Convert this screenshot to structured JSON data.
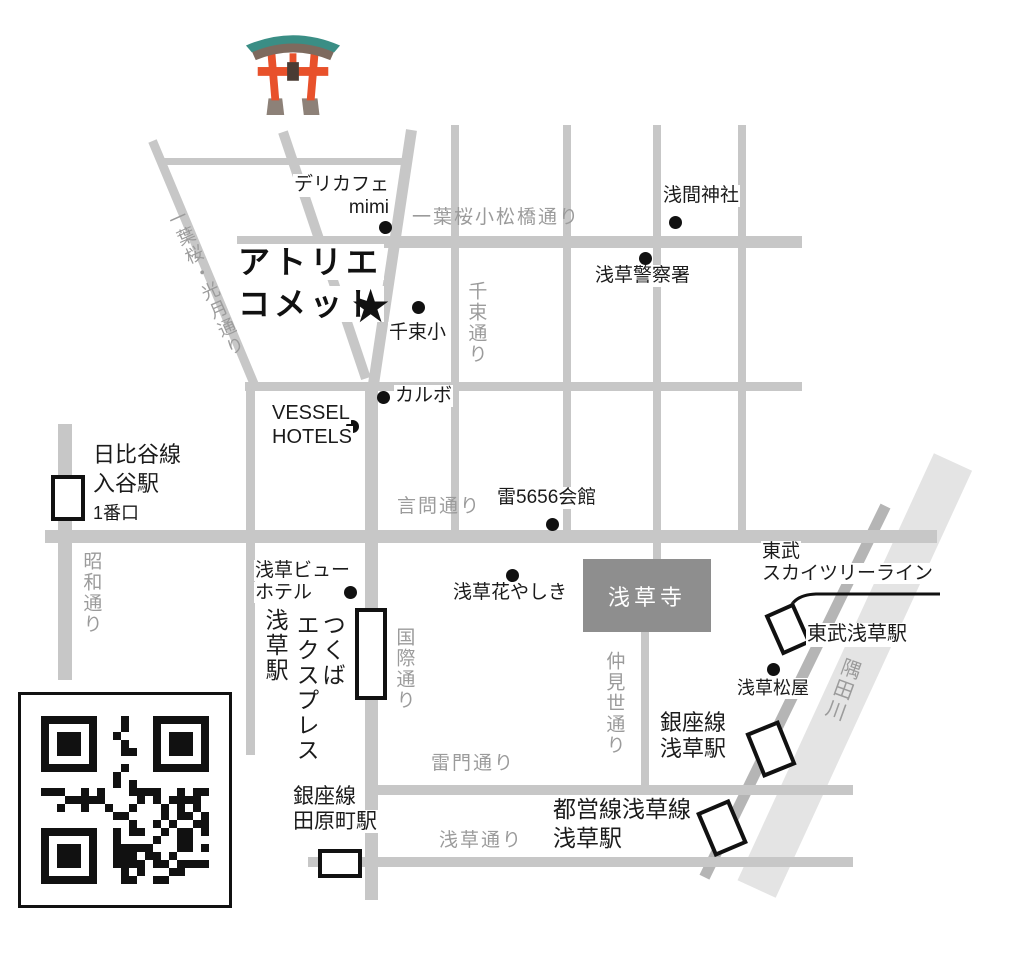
{
  "title": {
    "line1": "アトリエ",
    "line2": "コメット",
    "marker": "★"
  },
  "streets": {
    "komatsubashi": "一葉桜小松橋通り",
    "kogetsu": "一葉桜・光月通り",
    "senzoku": "千束通り",
    "showa": "昭和通り",
    "kototoi": "言問通り",
    "kokusai": "国際通り",
    "nakamise": "仲見世通り",
    "kaminarimon": "雷門通り",
    "asakusa": "浅草通り"
  },
  "river": {
    "name": "隅田川"
  },
  "places": {
    "delicafe": {
      "l1": "デリカフェ",
      "l2": "mimi"
    },
    "sengen": "浅間神社",
    "police": "浅草警察署",
    "senzokusho": "千束小",
    "karubo": "カルボ",
    "vessel": {
      "l1": "VESSEL",
      "l2": "HOTELS"
    },
    "k5656": "雷5656会館",
    "hanayashiki": "浅草花やしき",
    "viewhotel": {
      "l1": "浅草ビュー",
      "l2": "ホテル"
    },
    "sensoji": "浅草寺",
    "matsuya": "浅草松屋"
  },
  "stations": {
    "iriya": {
      "l1": "日比谷線",
      "l2": "入谷駅",
      "l3": "1番口"
    },
    "tobu_line": {
      "l1": "東武",
      "l2": "スカイツリーライン"
    },
    "tobu_asakusa": "東武浅草駅",
    "tx": {
      "c1": "つくば",
      "c2": "エクスプレス",
      "c3": "浅草駅"
    },
    "ginza_asakusa": {
      "l1": "銀座線",
      "l2": "浅草駅"
    },
    "tawaramachi": {
      "l1": "銀座線",
      "l2": "田原町駅"
    },
    "toei_asakusa": {
      "l1": "都営線浅草線",
      "l2": "浅草駅"
    }
  },
  "colors": {
    "street": "#c7c7c7",
    "railway": "#b5b5b5",
    "river": "#e4e4e4",
    "street_label": "#9b9b9b",
    "text": "#1b1b1b",
    "sensoji_box": "#8e8e8e",
    "torii_orange": "#e8512b",
    "torii_teal": "#3a8e85"
  }
}
